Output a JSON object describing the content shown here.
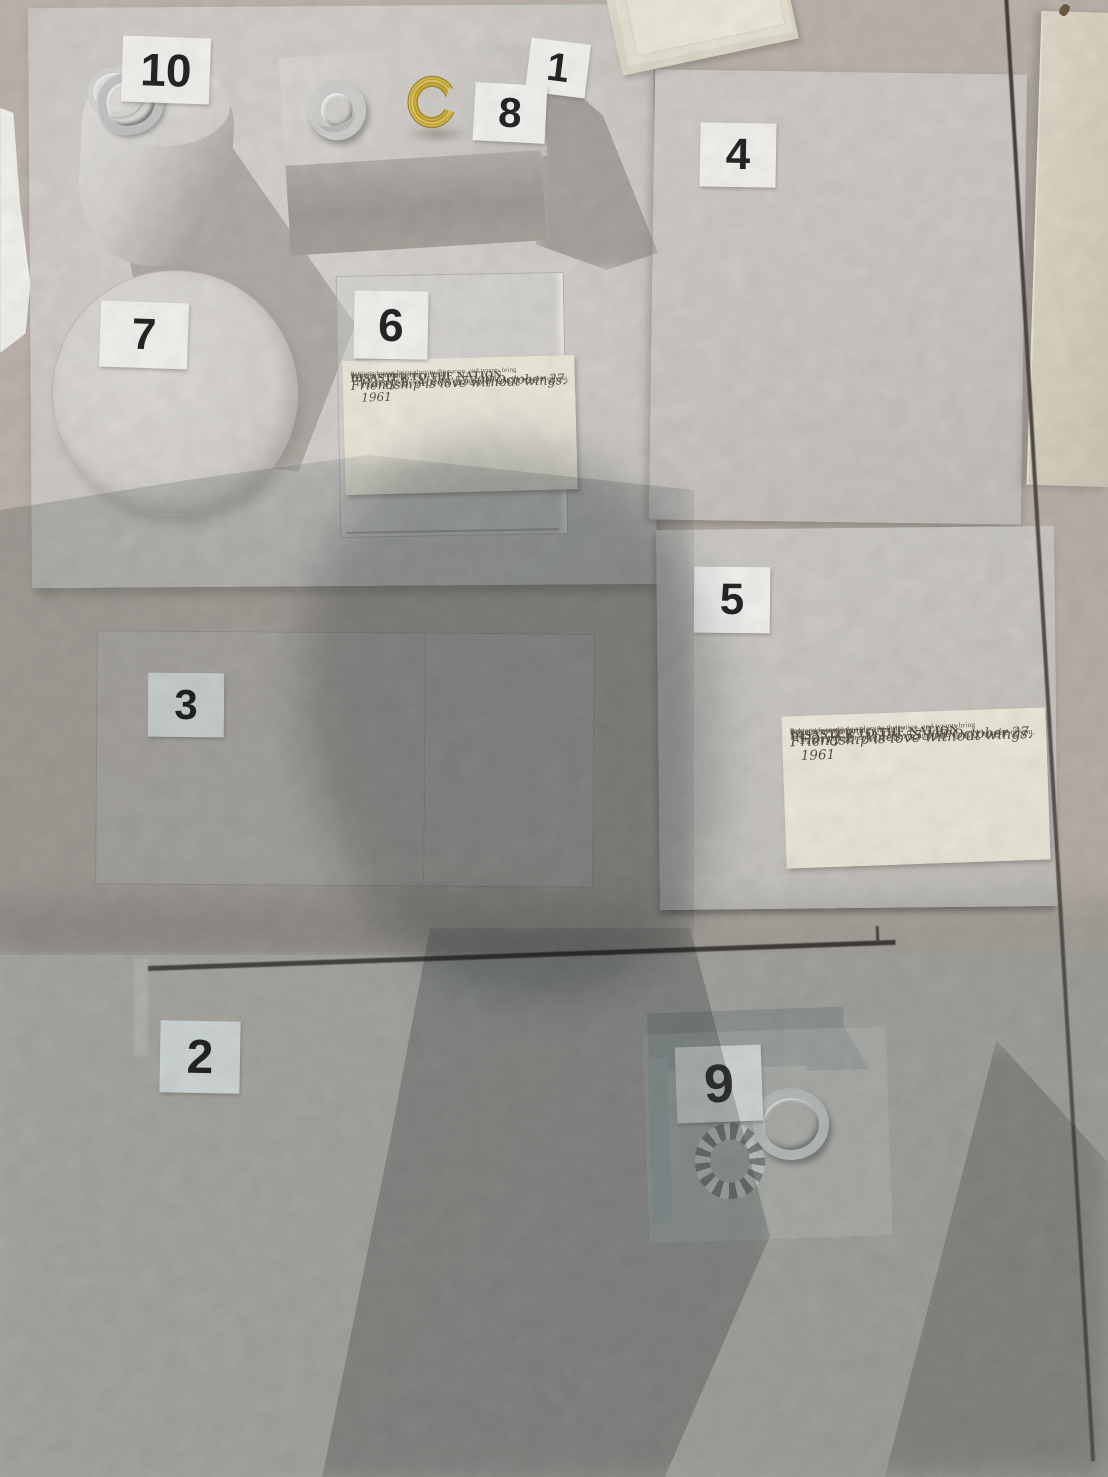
{
  "labels": {
    "n1": "1",
    "n2": "2",
    "n3": "3",
    "n4": "4",
    "n5": "5",
    "n6": "6",
    "n7": "7",
    "n8": "8",
    "n9": "9",
    "n10": "10"
  },
  "note_card": {
    "header_line": "Patriotic heroes bring glory to the nation, and tyrants bring",
    "title": "DISASTER TO THE NATION",
    "subtitle": "Adversity truth.",
    "script_line": "Friendship is love without wings.",
    "body_line": "Oh, fun, although some people are sure to be unlucky because of you.",
    "signature_line": "Harry E. Ables 55300 October 27, 1961",
    "closing_line": "You are so comforting after all."
  },
  "colors": {
    "gold_ring": "#c9a22a",
    "silver_ring": "#c6c8c7",
    "label_card": "#f6f5f2",
    "note_paper": "#eee9db",
    "floor": "#b2a89f"
  }
}
